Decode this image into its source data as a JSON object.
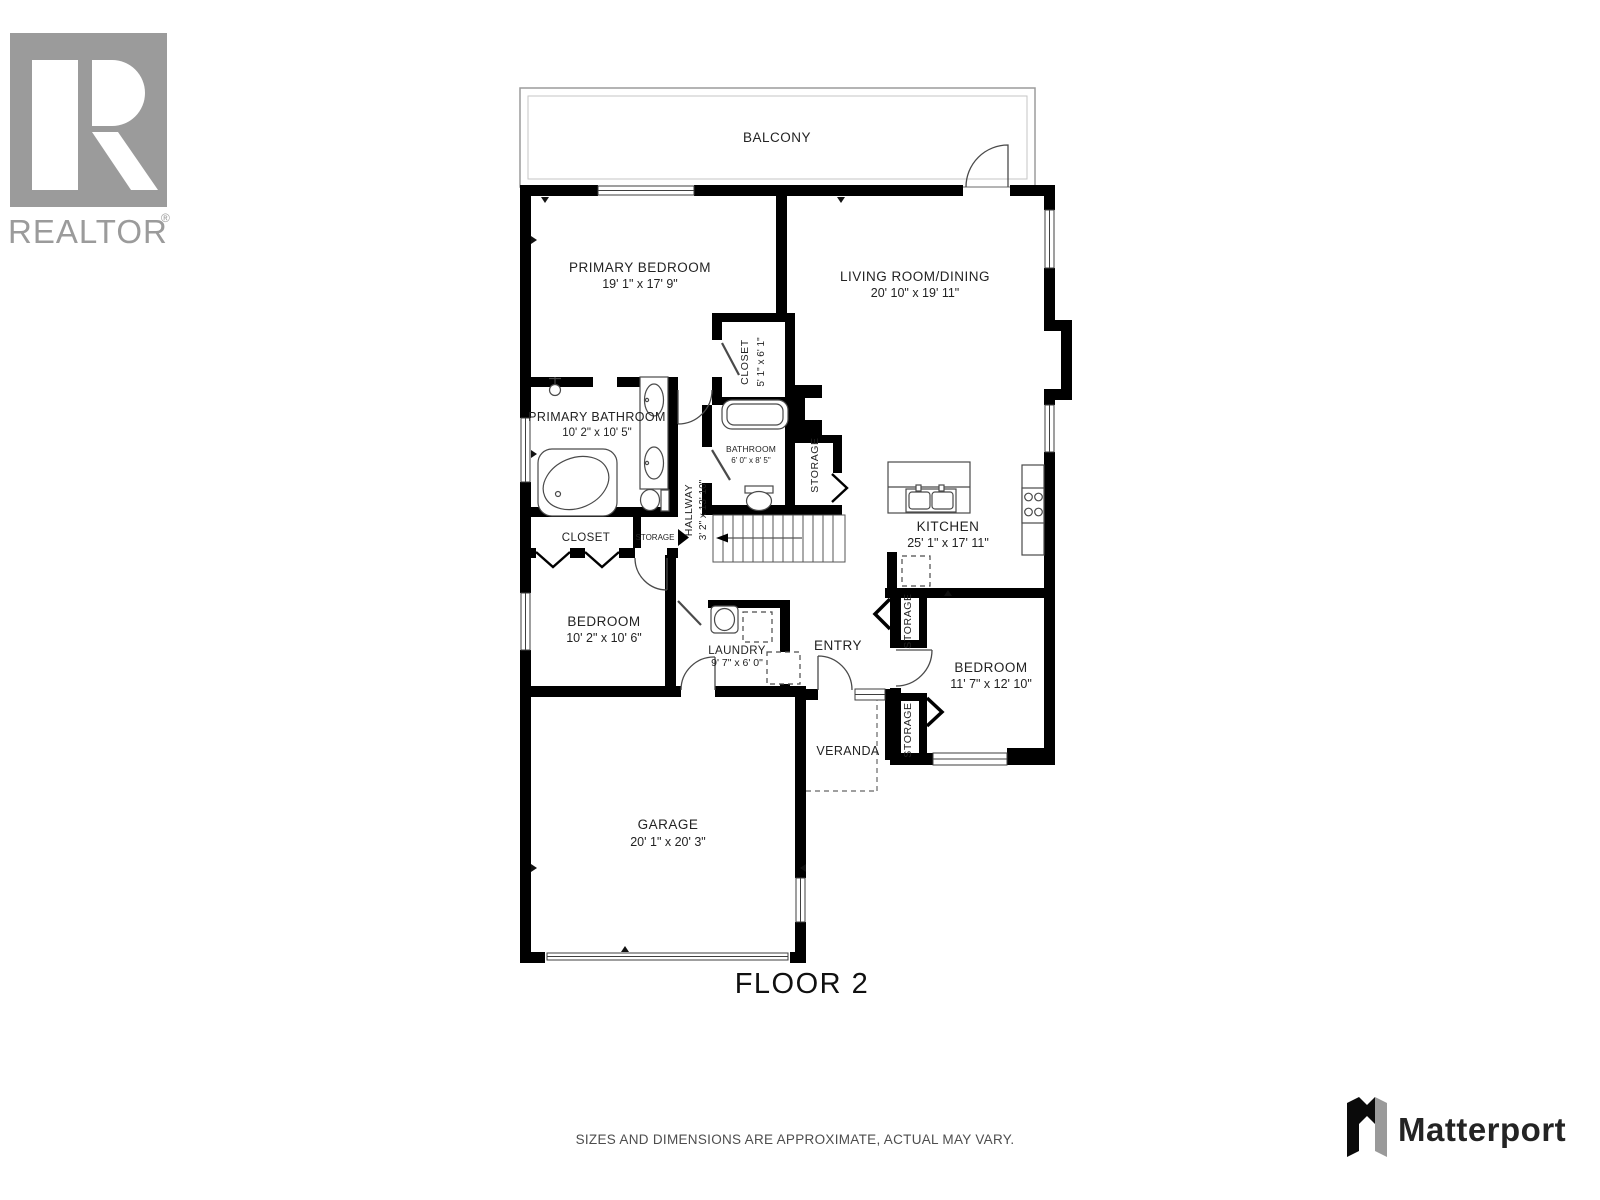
{
  "branding": {
    "realtor_label": "REALTOR",
    "realtor_reg": "®",
    "matterport_label": "Matterport"
  },
  "plan": {
    "floor_label": "FLOOR 2",
    "disclaimer": "SIZES AND DIMENSIONS ARE APPROXIMATE, ACTUAL MAY VARY.",
    "rooms": {
      "balcony": {
        "name": "BALCONY"
      },
      "primary_bedroom": {
        "name": "PRIMARY BEDROOM",
        "dims": "19' 1\" x 17' 9\""
      },
      "living_dining": {
        "name": "LIVING ROOM/DINING",
        "dims": "20' 10\" x 19' 11\""
      },
      "closet_upper": {
        "name": "CLOSET",
        "dims": "5' 1\" x 6' 1\""
      },
      "primary_bathroom": {
        "name": "PRIMARY BATHROOM",
        "dims": "10' 2\" x 10' 5\""
      },
      "bathroom": {
        "name": "BATHROOM",
        "dims": "6' 0\" x 8' 5\""
      },
      "storage_bath": {
        "name": "STORAGE"
      },
      "hallway": {
        "name": "HALLWAY",
        "dims": "3' 2\" x 13' 10\""
      },
      "kitchen": {
        "name": "KITCHEN",
        "dims": "25' 1\" x 17' 11\""
      },
      "closet_hall": {
        "name": "CLOSET"
      },
      "storage_hall": {
        "name": "STORAGE"
      },
      "bedroom_left": {
        "name": "BEDROOM",
        "dims": "10' 2\" x 10' 6\""
      },
      "laundry": {
        "name": "LAUNDRY",
        "dims": "9' 7\" x 6' 0\""
      },
      "entry": {
        "name": "ENTRY"
      },
      "storage_top": {
        "name": "STORAGE"
      },
      "bedroom_right": {
        "name": "BEDROOM",
        "dims": "11' 7\" x 12' 10\""
      },
      "storage_bottom": {
        "name": "STORAGE"
      },
      "veranda": {
        "name": "VERANDA"
      },
      "garage": {
        "name": "GARAGE",
        "dims": "20' 1\" x 20' 3\""
      }
    },
    "colors": {
      "wall": "#000000",
      "thin_line": "#4a4a4a",
      "balcony_line": "#9c9c9c",
      "logo_gray": "#9b9b9b",
      "disclaimer_text": "#4d4d4d"
    }
  }
}
